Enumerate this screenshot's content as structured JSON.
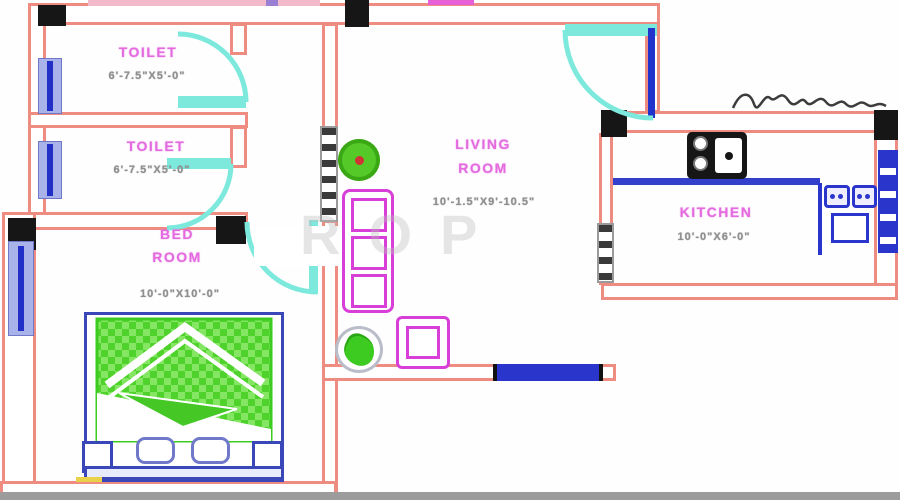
{
  "page": {
    "type": "residential floor plan"
  },
  "rooms": {
    "toilet1": {
      "label": "TOILET",
      "dims": "6'-7.5\"X5'-0\""
    },
    "toilet2": {
      "label": "TOILET",
      "dims": "6'-7.5\"X5'-0\""
    },
    "bedroom": {
      "label_line1": "BED",
      "label_line2": "ROOM",
      "dims": "10'-0\"X10'-0\""
    },
    "living": {
      "label_line1": "LIVING",
      "label_line2": "ROOM",
      "dims": "10'-1.5\"X9'-10.5\""
    },
    "kitchen": {
      "label": "KITCHEN",
      "dims": "10'-0\"X6'-0\""
    }
  },
  "watermark": {
    "text": "ROP"
  },
  "colors": {
    "wall": "#ef8c82",
    "column": "#161616",
    "door": "#7de8dc",
    "window_blue": "#2a35cc",
    "furniture_magenta": "#d83fd8",
    "bed_frame_blue": "#3a47b8",
    "bed_green": "#3ecb21",
    "label_magenta": "#e46ae0",
    "dims_grey": "#8f8f8f"
  }
}
